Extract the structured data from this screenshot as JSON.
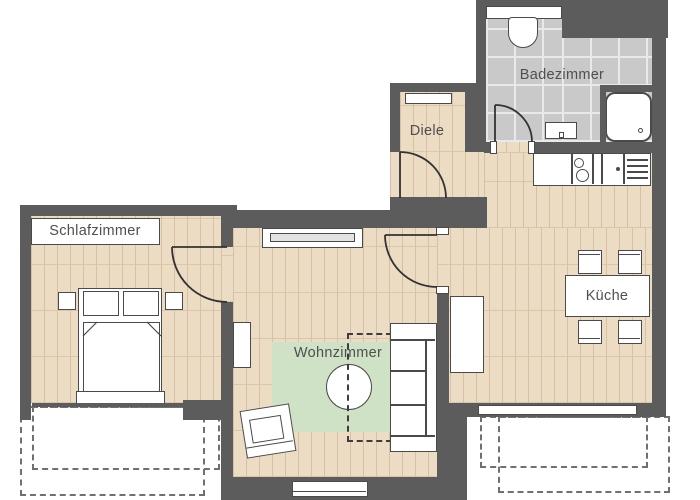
{
  "labels": {
    "schlafzimmer": "Schlafzimmer",
    "wohnzimmer": "Wohnzimmer",
    "diele": "Diele",
    "badezimmer": "Badezimmer",
    "kueche": "Küche"
  },
  "colors": {
    "wall": "#5c5c5c",
    "wood_floor": "#eddcc4",
    "wood_plank_line": "#d7c1a4",
    "tile_floor": "#c9c9c9",
    "tile_grout": "#e9e9e9",
    "rug_green": "#cfe2c6",
    "furniture_outline": "#4a4a4a",
    "label_text": "#4f4f4f",
    "balcony_dash": "#707070",
    "door_stroke": "#333333"
  }
}
